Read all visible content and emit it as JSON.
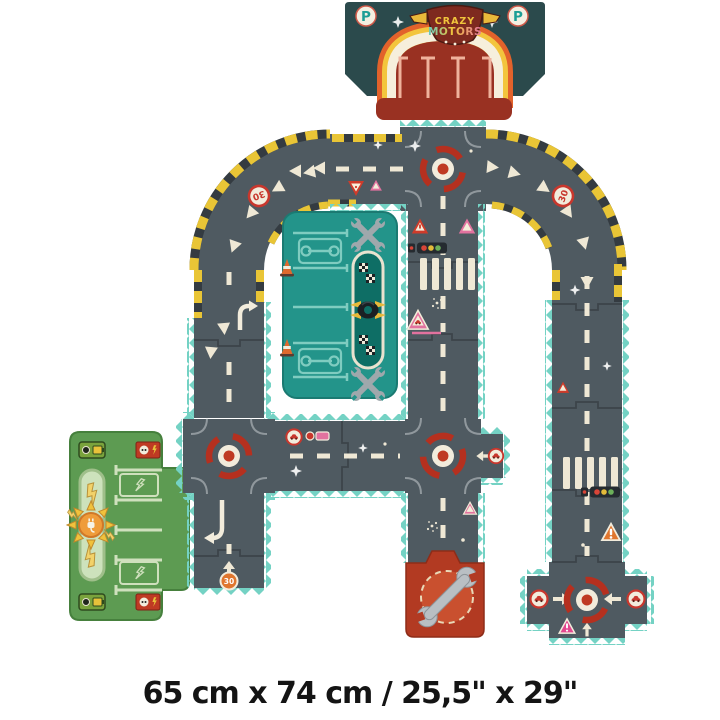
{
  "product_image": {
    "description": "toy road-track puzzle product illustration",
    "brand_badge": {
      "line1": "CRAZY",
      "line2": "MOTORS"
    },
    "parking_sign_letter": "P",
    "speed_limit_sign": "30",
    "dimensions_caption": "65 cm x 74 cm / 25,5\" x 29\"",
    "colors": {
      "road": "#4f5a61",
      "edge_teal": "#74d2c4",
      "marking_cream": "#efe8d5",
      "hazard_yellow": "#e9c536",
      "hazard_dark": "#343b41",
      "roundabout_red": "#b5301f",
      "sign_red": "#c8372d",
      "pink": "#e2729f",
      "orange": "#e0762e",
      "workshop_teal": "#23948a",
      "workshop_light": "#7fccc0",
      "charging_green": "#5d9b52",
      "charging_light": "#cfe0bd",
      "garage_teal": "#2b4a4c",
      "garage_lot_red": "#993122",
      "rainbow_orange": "#e2622b",
      "rainbow_yellow": "#f3c53d",
      "rainbow_cream": "#f6efdc",
      "wrench_piece_red": "#b23a22"
    },
    "icons": [
      "parking-sign",
      "roundabout",
      "traffic-light",
      "pedestrian-crossing",
      "speed-limit-30-sign",
      "yield-sign",
      "warning-triangle",
      "car-sign",
      "direction-arrow",
      "chevron",
      "wrench",
      "crossed-wrenches",
      "traffic-cone",
      "checkered-flag",
      "winged-tire",
      "lightning-bolt",
      "charging-plug-sun",
      "battery-charger",
      "sparkle"
    ],
    "pieces": [
      "parking-garage",
      "crossroads-roundabout",
      "curve-left",
      "curve-right",
      "straight-roads",
      "left-roundabout",
      "middle-roundabout",
      "bottom-roundabout",
      "workshop-garage",
      "charging-station",
      "wrench-end-piece",
      "road-end-cap"
    ]
  }
}
